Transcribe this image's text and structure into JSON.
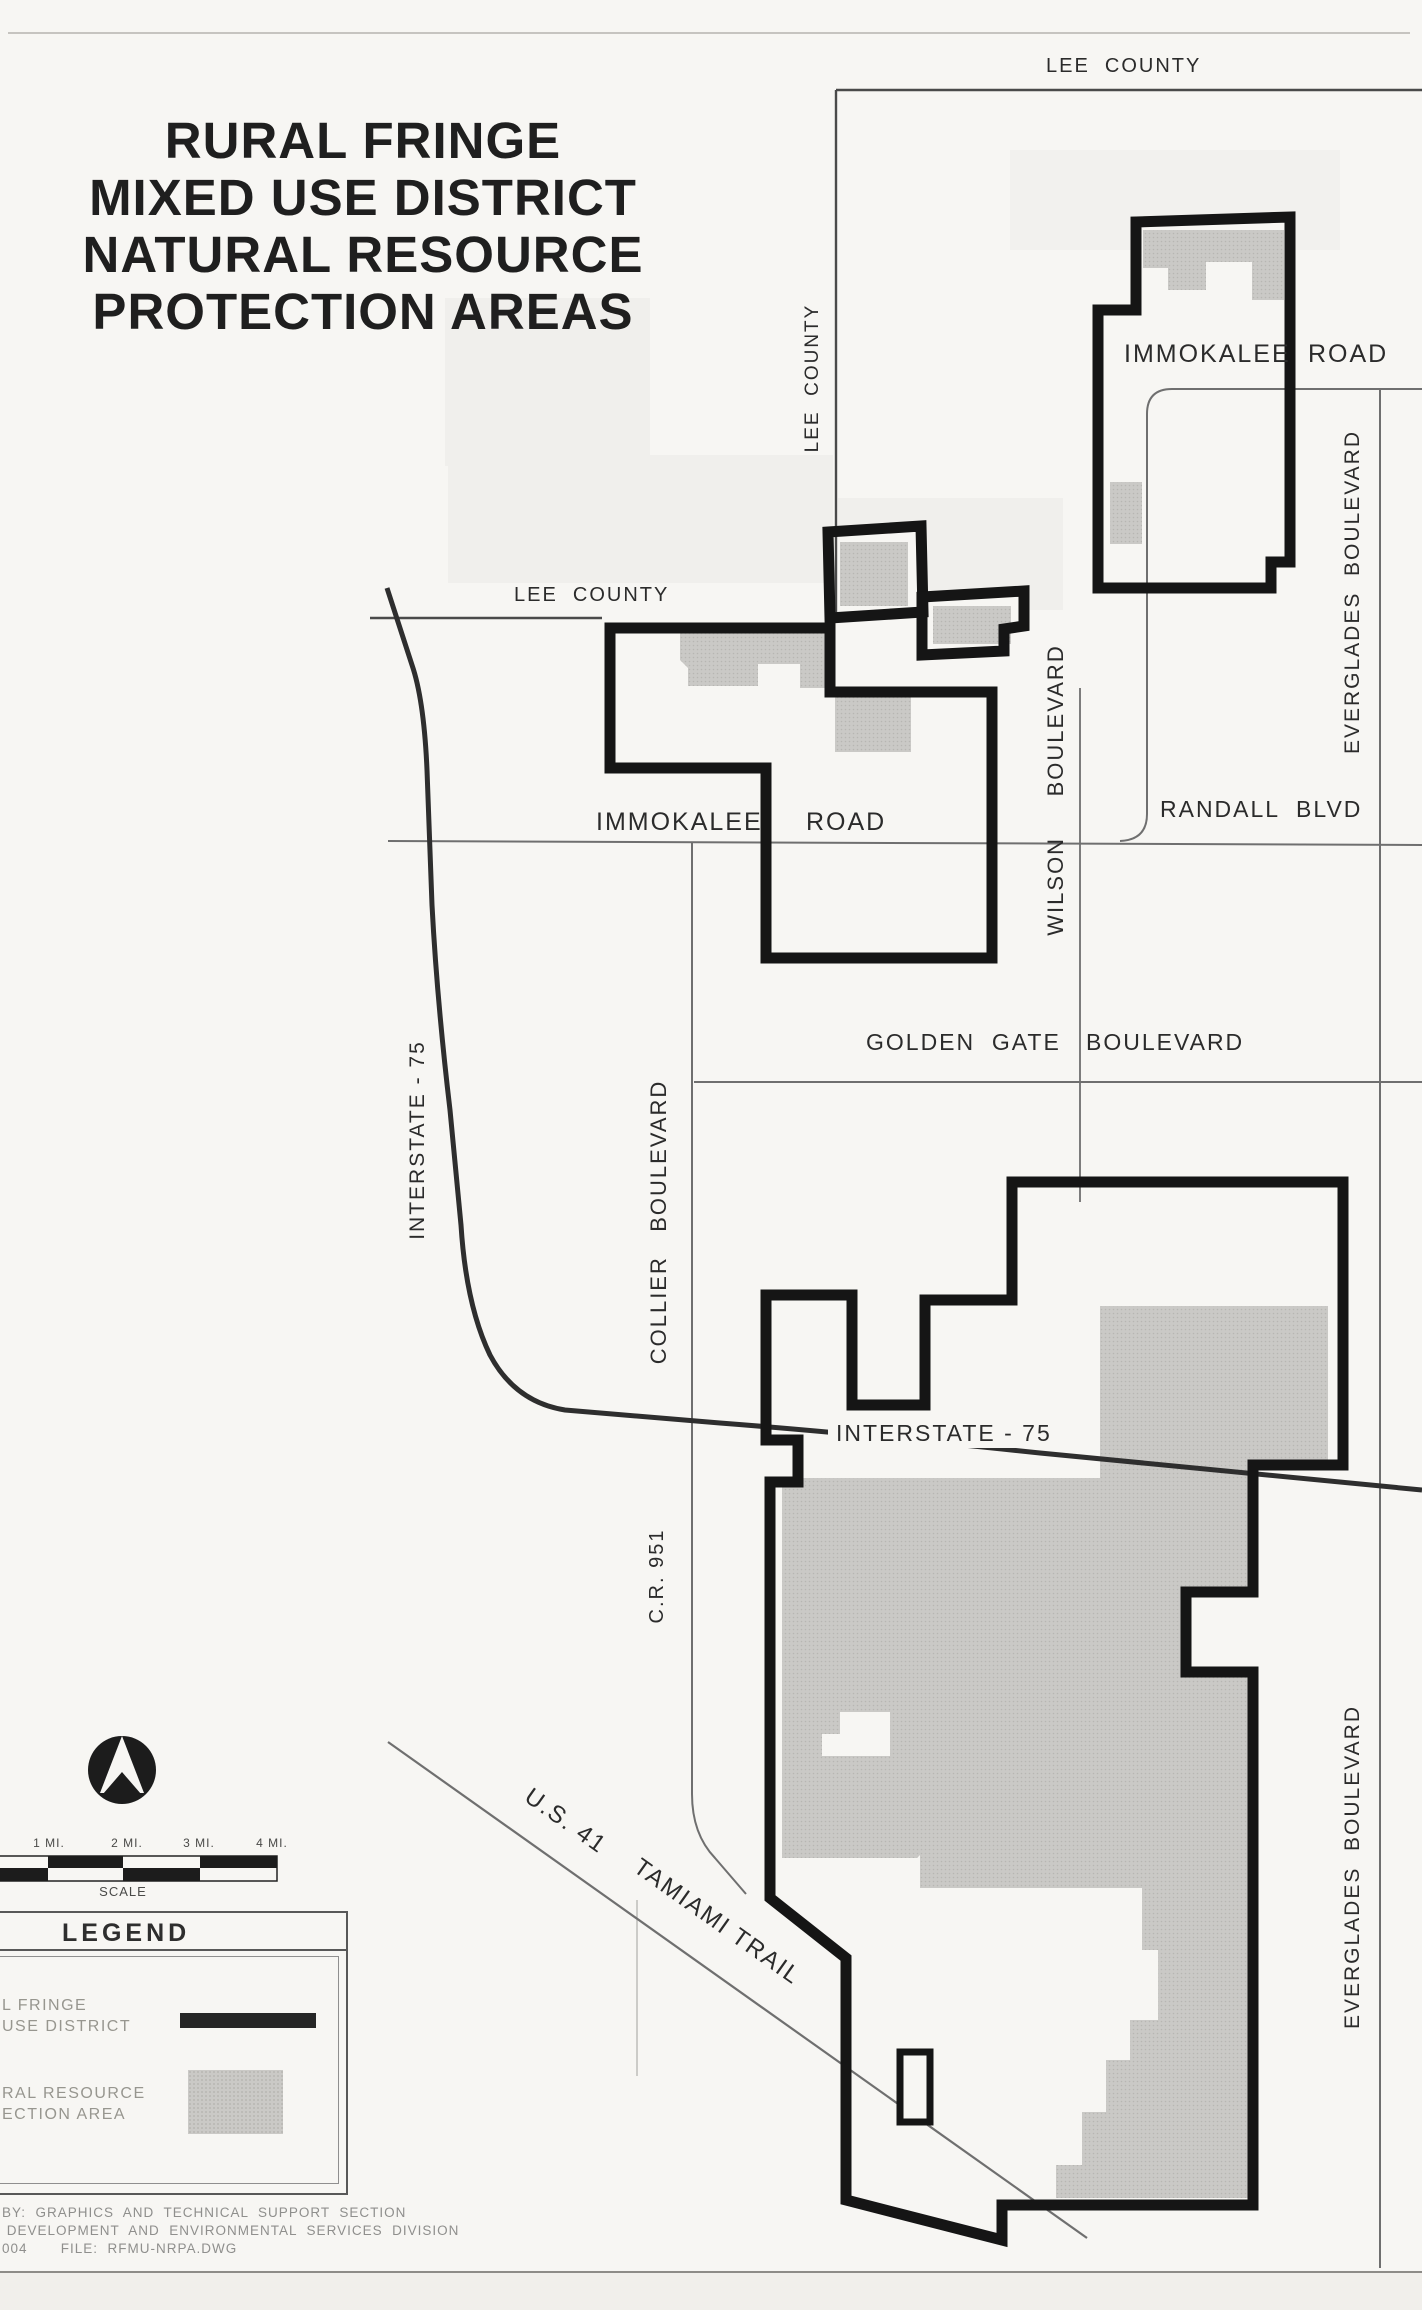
{
  "page": {
    "title_lines": [
      "RURAL FRINGE",
      "MIXED USE DISTRICT",
      "NATURAL RESOURCE",
      "PROTECTION AREAS"
    ]
  },
  "map": {
    "labels": {
      "lee_county_top": "LEE  COUNTY",
      "lee_county_vertical": "LEE  COUNTY",
      "lee_county_west": "LEE  COUNTY",
      "immokalee_ne": "IMMOKALEE",
      "road_ne": "ROAD",
      "everglades_upper": "EVERGLADES  BOULEVARD",
      "randall": "RANDALL  BLVD",
      "wilson": "WILSON     BOULEVARD",
      "immokalee_central": "IMMOKALEE",
      "road_central": "ROAD",
      "golden_gate": "GOLDEN  GATE   BOULEVARD",
      "collier": "COLLIER   BOULEVARD",
      "interstate_left": "INTERSTATE - 75",
      "interstate_mid": "INTERSTATE - 75",
      "cr951": "C.R. 951",
      "everglades_lower": "EVERGLADES  BOULEVARD",
      "us41": "U.S. 41",
      "tamiami": "TAMIAMI TRAIL"
    },
    "scale": {
      "ticks": [
        "1 MI.",
        "2 MI.",
        "3 MI.",
        "4 MI."
      ],
      "caption": "SCALE"
    },
    "legend": {
      "title": "LEGEND",
      "items": [
        {
          "line1": "L FRINGE",
          "line2": "USE DISTRICT",
          "symbol": "district-boundary-line"
        },
        {
          "line1": "RAL RESOURCE",
          "line2": "ECTION AREA",
          "symbol": "nrpa-gray-fill"
        }
      ]
    },
    "credits": [
      "BY:  GRAPHICS  AND  TECHNICAL  SUPPORT  SECTION",
      " DEVELOPMENT  AND  ENVIRONMENTAL  SERVICES  DIVISION",
      "004       FILE:  RFMU-NRPA.DWG"
    ],
    "colors": {
      "district_boundary": "#151515",
      "nrpa_fill": "#cac9c6",
      "road": "#6f6f6f",
      "county_line": "#4a4a4a",
      "paper": "#f7f6f3",
      "faded_text": "#97968f",
      "ink": "#2b2b2b"
    }
  }
}
